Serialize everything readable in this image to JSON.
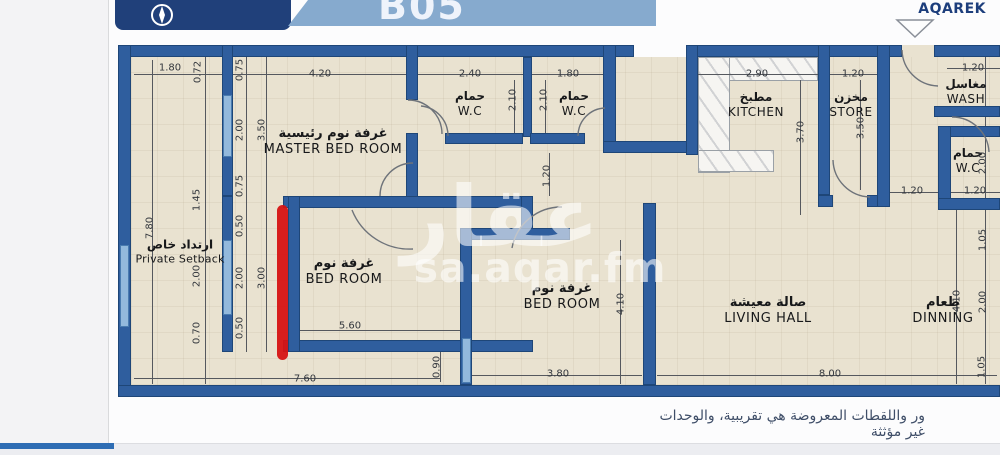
{
  "header": {
    "unit": "B05",
    "brand": "AQAREK",
    "compass": "N"
  },
  "watermark": {
    "arabic": "عقار",
    "domain": "sa.aqar.fm"
  },
  "rooms": {
    "master": {
      "ar": "غرفة نوم رئيسية",
      "en": "MASTER BED ROOM"
    },
    "wc1": {
      "ar": "حمام",
      "en": "W.C"
    },
    "wc2": {
      "ar": "حمام",
      "en": "W.C"
    },
    "wc3": {
      "ar": "حمام",
      "en": "W.C"
    },
    "kitchen": {
      "ar": "مطبخ",
      "en": "KITCHEN"
    },
    "store": {
      "ar": "مخزن",
      "en": "STORE"
    },
    "wash": {
      "ar": "مغاسل",
      "en": "WASH"
    },
    "bed1": {
      "ar": "غرفة نوم",
      "en": "BED ROOM"
    },
    "bed2": {
      "ar": "غرفة نوم",
      "en": "BED ROOM"
    },
    "living": {
      "ar": "صالة معيشة",
      "en": "LIVING HALL"
    },
    "dinning": {
      "ar": "طعام",
      "en": "DINNING"
    },
    "setback": {
      "ar": "ارتداد خاص",
      "en": "Private Setback"
    }
  },
  "dims": [
    "1.80",
    "0.72",
    "0.75",
    "4.20",
    "2.40",
    "1.80",
    "2.90",
    "1.20",
    "1.20",
    "2.00",
    "3.50",
    "2.10",
    "2.10",
    "3.70",
    "3.50",
    "0.75",
    "1.45",
    "7.80",
    "0.50",
    "1.20",
    "2.00",
    "2.00",
    "2.00",
    "3.00",
    "1.20",
    "1.20",
    "1.05",
    "5.60",
    "0.50",
    "0.70",
    "4.10",
    "4.10",
    "2.00",
    "7.60",
    "0.90",
    "3.80",
    "8.00",
    "1.05"
  ],
  "footer": {
    "disclaimer": "ور واللقطات المعروضة هي تقريبية، والوحدات غير مؤثثة"
  },
  "colors": {
    "wall": "#2f5e9e",
    "floor": "#e9e2d0",
    "annotation": "#d61313",
    "band": "#86aace",
    "navy": "#20407a",
    "window": "#93b9dc"
  }
}
